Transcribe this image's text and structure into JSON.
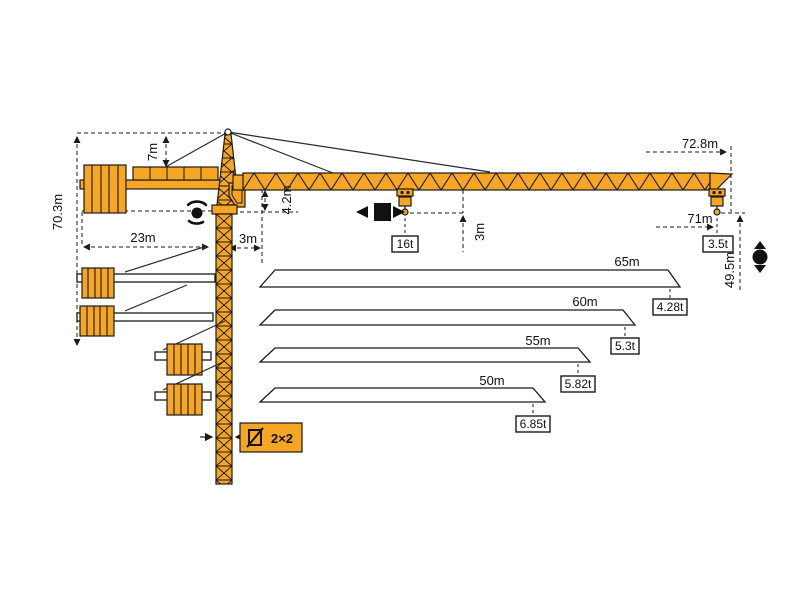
{
  "title": "Tower crane dimension and load diagram",
  "colors": {
    "crane_orange": "#F6A623",
    "line_black": "#1a1a1a",
    "background": "#ffffff"
  },
  "dimensions": {
    "total_height": "70.3m",
    "tower_head_height": "7m",
    "counter_jib_length": "23m",
    "min_hook_radius": "3m",
    "jib_section_height": "4.2m",
    "trolley_hook_offset": "3m",
    "jib_tip_radius": "72.8m",
    "max_hook_radius": "71m",
    "hook_height": "49.5m"
  },
  "capacities": {
    "max_load": "16t",
    "tip_load": "3.5t"
  },
  "mast": {
    "section_label": "2×2"
  },
  "icons": {
    "slewing": "slewing-rotation-icon",
    "trolley": "trolley-travel-icon",
    "hoist": "hoist-up-down-icon",
    "mast_section": "mast-cross-section-icon"
  },
  "chart_data": {
    "type": "table",
    "title": "Jib length vs tip capacity",
    "rows": [
      {
        "jib_length": "65m",
        "tip_capacity": "4.28t"
      },
      {
        "jib_length": "60m",
        "tip_capacity": "5.3t"
      },
      {
        "jib_length": "55m",
        "tip_capacity": "5.82t"
      },
      {
        "jib_length": "50m",
        "tip_capacity": "6.85t"
      }
    ]
  }
}
